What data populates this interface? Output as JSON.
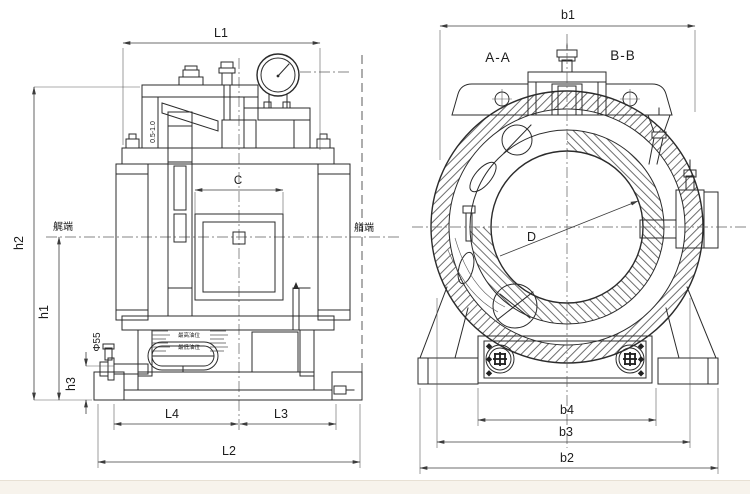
{
  "drawing": {
    "left_view": {
      "name": "bearing longitudinal section",
      "dim_L1": "L1",
      "dim_L2": "L2",
      "dim_L3": "L3",
      "dim_L4": "L4",
      "dim_h1": "h1",
      "dim_h2": "h2",
      "dim_h3": "h3",
      "dim_C": "C",
      "dim_phi55": "Φ55",
      "clearance_note": "0.5-1.0",
      "label_stern_end": "艉端",
      "label_bow_end": "艏端",
      "label_oil_max": "最高油位",
      "label_oil_min": "最低油位"
    },
    "right_view": {
      "name": "bearing end section",
      "section_a": "A-A",
      "section_b": "B-B",
      "dim_b1": "b1",
      "dim_b2": "b2",
      "dim_b3": "b3",
      "dim_b4": "b4",
      "dim_D": "D"
    },
    "colors": {
      "line": "#2b2b2b",
      "hatch": "#3a3a3a",
      "background": "#ffffff",
      "footer_band": "#f7f3ec"
    }
  }
}
